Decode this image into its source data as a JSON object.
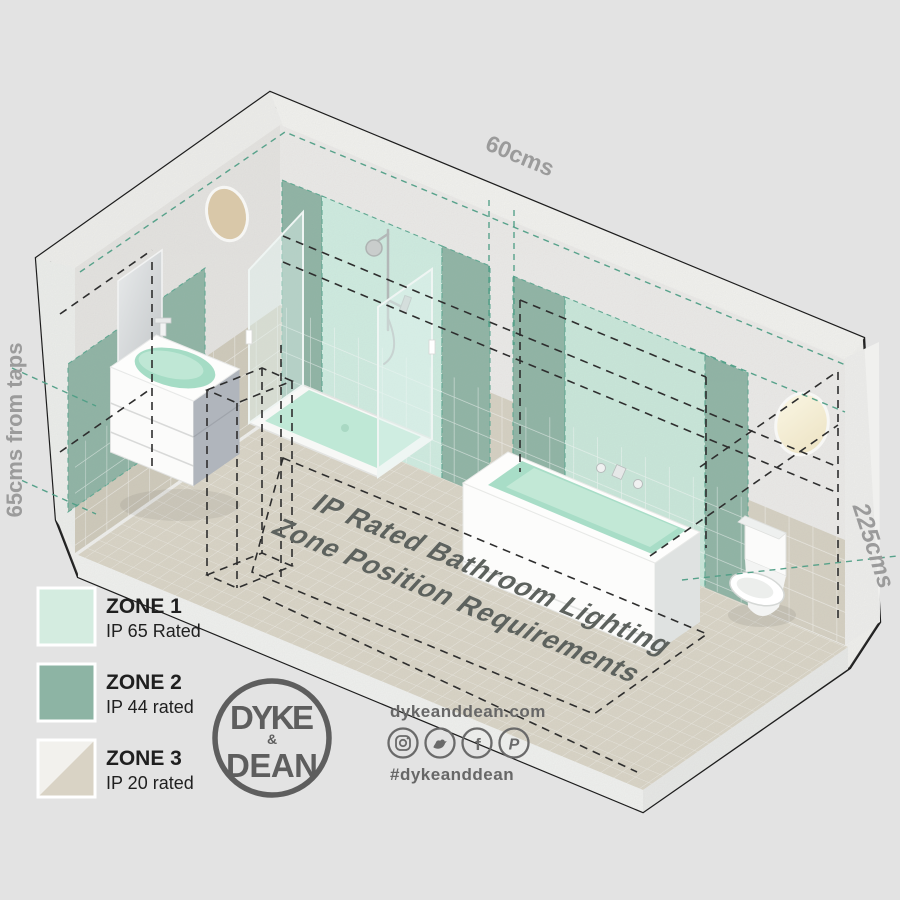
{
  "floor_title": {
    "line1": "IP Rated Bathroom Lighting",
    "line2": "Zone Position Requirements"
  },
  "dimensions": {
    "top": "60cms",
    "left": "65cms from taps",
    "right": "225cms"
  },
  "legend": {
    "zones": [
      {
        "name": "ZONE 1",
        "rating": "IP 65 Rated",
        "swatch": "#d4ece0"
      },
      {
        "name": "ZONE 2",
        "rating": "IP 44 rated",
        "swatch": "#8db4a4"
      },
      {
        "name": "ZONE 3",
        "rating": "IP 20 rated",
        "swatch_top": "#f2f1ed",
        "swatch_bottom": "#d9d3c5"
      }
    ]
  },
  "brand": {
    "logo_lines": [
      "DYKE",
      "&",
      "DEAN"
    ],
    "website": "dykeanddean.com",
    "hashtag": "#dykeanddean",
    "social_icons": [
      "instagram-icon",
      "twitter-icon",
      "facebook-icon",
      "pinterest-icon"
    ]
  },
  "colors": {
    "background": "#e3e3e3",
    "zone1_mint": "#cdeadd",
    "zone2_green": "#8cb3a3",
    "zone3_beige": "#d9d3c5",
    "tile_beige": "#d6d1c2",
    "floor_beige": "#dad5c6",
    "concrete": "#efeeec",
    "dashed_teal": "#4f9e86",
    "dashed_black": "#2e2e2e",
    "label_gray": "#9b9b9b",
    "brand_gray": "#5e5e5e"
  }
}
